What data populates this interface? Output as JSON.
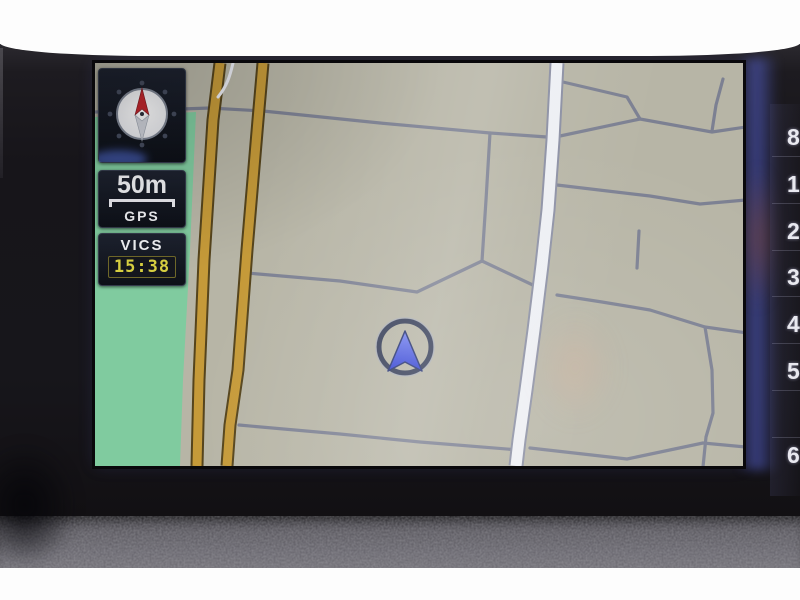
{
  "device": {
    "kind": "in-dash car navigation unit",
    "view": "map screen, north-up"
  },
  "hud": {
    "compass": {
      "icon": "compass-rose-icon",
      "north_color": "#c1272d"
    },
    "scale": {
      "distance": "50m",
      "signal": "GPS"
    },
    "traffic": {
      "label": "VICS",
      "time": "15:38",
      "time_color": "#d8d041"
    }
  },
  "bezel": {
    "side_digits": [
      "8",
      "1",
      "2",
      "3",
      "4",
      "5",
      "6"
    ]
  },
  "map": {
    "position_indicator": {
      "type": "current-location-arrow",
      "arrow_color": "#3e54e0",
      "ring_color": "#333b55"
    },
    "colors": {
      "land": "#b7b5a6",
      "green_area": "#80cb9f",
      "major_road": "#c59a39",
      "major_road_edge": "#55441c",
      "primary_road": "#edeff4",
      "primary_road_edge": "#8b8fa3",
      "minor_road": "#7c8092"
    },
    "areas": {
      "green_polygon": "95,117 196,112 190,250 183,380 180,466 95,466"
    },
    "roads": {
      "minor": [
        "M95,112 L210,108 L263,111 L380,123 L490,133 L547,137",
        "M490,133 L486,200 L482,261",
        "M247,273 L340,281 L417,292 L482,261",
        "M482,261 L537,287",
        "M557,295 L602,302 L650,310 L705,327 L747,333",
        "M705,327 L712,370 L713,413 L706,437 L703,467",
        "M563,82 L627,97 L640,119",
        "M560,136 L640,119 L712,132 L746,127",
        "M723,79 L716,105 L712,131",
        "M557,185 L650,196 L700,204 L746,200",
        "M639,231 L637,268",
        "M239,425 L340,434 L420,442 L519,450",
        "M530,448 L627,459 L703,443 L746,447"
      ],
      "major": [
        "M220,63 L213,120 L204,260 L199,380 L197,466",
        "M263,63 L258,120 L247,250 L238,370 L230,425 L227,466"
      ],
      "primary": [
        "M557,63 L553,140 L548,210 L542,265 L534,330 L526,390 L519,440 L516,466"
      ],
      "primary_stub": "M233,63 C230,76 227,86 218,97"
    }
  }
}
